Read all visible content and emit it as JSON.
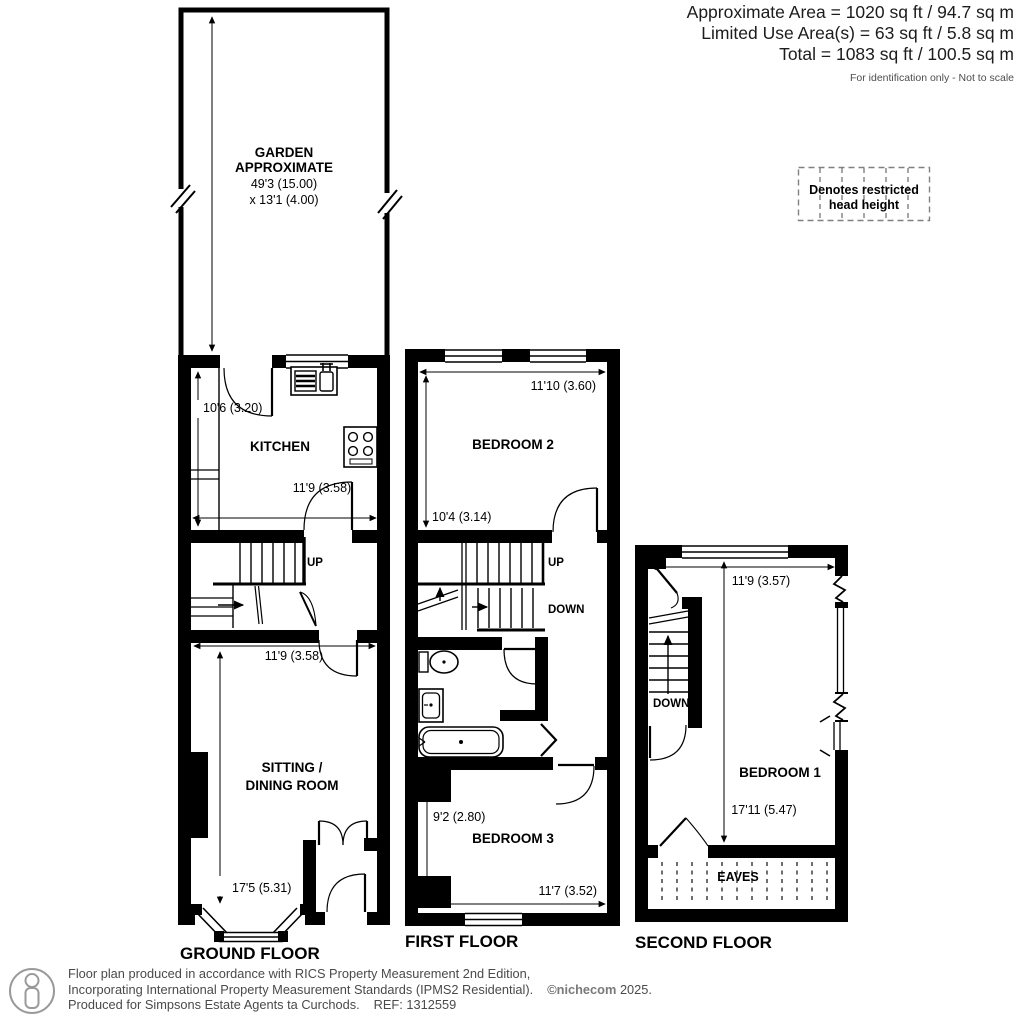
{
  "title_block": {
    "approximate_area": "Approximate Area = 1020 sq ft / 94.7 sq m",
    "limited_use_area": "Limited Use Area(s) = 63 sq ft / 5.8 sq m",
    "total_area": "Total = 1083 sq ft / 100.5 sq m",
    "note": "For identification only - Not to scale"
  },
  "legend": {
    "line1": "Denotes restricted",
    "line2": "head height"
  },
  "ground_floor": {
    "floor_label": "GROUND FLOOR",
    "garden_line1": "GARDEN",
    "garden_line2": "APPROXIMATE",
    "garden_dim1": "49'3 (15.00)",
    "garden_dim2": "x 13'1 (4.00)",
    "kitchen_label": "KITCHEN",
    "kitchen_depth": "10'6 (3.20)",
    "kitchen_width": "11'9 (3.58)",
    "up_label": "UP",
    "sitting_width": "11'9 (3.58)",
    "sitting_line1": "SITTING /",
    "sitting_line2": "DINING ROOM",
    "sitting_depth": "17'5 (5.31)"
  },
  "first_floor": {
    "floor_label": "FIRST FLOOR",
    "bedroom2_label": "BEDROOM 2",
    "bedroom2_width": "11'10 (3.60)",
    "bedroom2_depth": "10'4 (3.14)",
    "up_label": "UP",
    "down_label": "DOWN",
    "bedroom3_depth": "9'2 (2.80)",
    "bedroom3_label": "BEDROOM 3",
    "bedroom3_width": "11'7 (3.52)"
  },
  "second_floor": {
    "floor_label": "SECOND FLOOR",
    "width": "11'9 (3.57)",
    "down_label": "DOWN",
    "bedroom1_label": "BEDROOM 1",
    "bedroom1_depth": "17'11 (5.47)",
    "eaves_label": "EAVES"
  },
  "footer": {
    "line1": "Floor plan produced in accordance with RICS Property Measurement 2nd Edition,",
    "line2": "Incorporating International Property Measurement Standards (IPMS2 Residential).",
    "copyright_symbol": "©",
    "copyright_brand": "nichecom",
    "copyright_year": "2025.",
    "line3": "Produced for Simpsons Estate Agents ta Curchods.",
    "ref": "REF: 1312559"
  },
  "colors": {
    "wall": "#000000",
    "text": "#000000",
    "muted": "#4a4a4a"
  }
}
